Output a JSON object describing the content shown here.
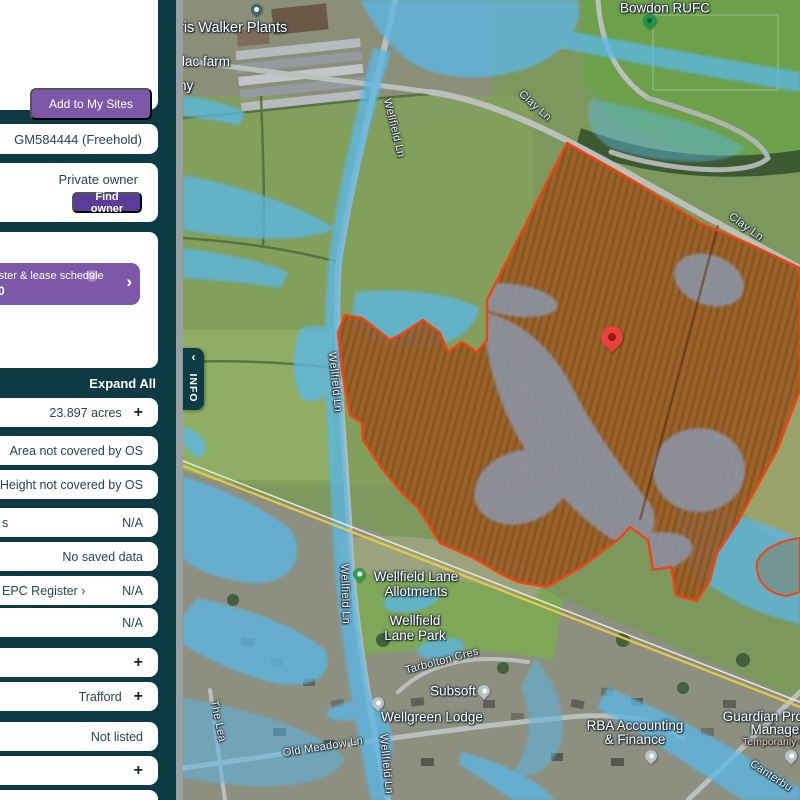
{
  "sidebar": {
    "add_button": "Add to My Sites",
    "title_ref": "GM584444 (Freehold)",
    "ownership": {
      "status": "Private owner",
      "find_owner": "Find owner"
    },
    "purchase_banner": {
      "line1": "gister & lease schedule",
      "help_badge": "?",
      "line2": ".00",
      "chevron": "›"
    },
    "expand_all": "Expand All",
    "rows": [
      {
        "label": "",
        "value": "23.897 acres",
        "expand": "+"
      },
      {
        "label": "",
        "value": "Area not covered by OS",
        "expand": ""
      },
      {
        "label": "",
        "value": "Height not covered by OS",
        "expand": ""
      },
      {
        "label": "s",
        "value": "N/A",
        "expand": ""
      },
      {
        "label": "",
        "value": "No saved data",
        "expand": ""
      },
      {
        "label": "EPC Register ›",
        "value": "N/A",
        "expand": ""
      },
      {
        "label": "",
        "value": "N/A",
        "expand": ""
      },
      {
        "label": "",
        "value": "",
        "expand": "+"
      },
      {
        "label": "",
        "value": "Trafford",
        "expand": "+"
      },
      {
        "label": "",
        "value": "Not listed",
        "expand": ""
      },
      {
        "label": "",
        "value": "",
        "expand": "+"
      }
    ]
  },
  "map": {
    "info_tab": {
      "label": "INFO",
      "collapse": "‹"
    },
    "labels": {
      "bowdon_rufc": "Bowdon RUFC",
      "walker_plants": "ris Walker Plants",
      "lilac_farm": "ilac farm",
      "farm_suffix": "ny",
      "clay_ln": "Clay Ln",
      "wellfield_ln": "Wellfield Ln",
      "allotments_line1": "Wellfield Lane",
      "allotments_line2": "Allotments",
      "park_line1": "Wellfield",
      "park_line2": "Lane Park",
      "tarbolton_cres": "Tarbolton Cres",
      "subsoft": "Subsoft",
      "wellgreen_lodge": "Wellgreen Lodge",
      "rba_line1": "RBA Accounting",
      "rba_line2": "& Finance",
      "guardian_line1": "Guardian Prope",
      "guardian_line2": "Manageme",
      "guardian_line3": "Temporarily clos",
      "canterbury": "Canterbu",
      "old_meadow_ln": "Old Meadow Ln",
      "the_lea": "The Lea"
    },
    "pins": {
      "selected_site": "red-location-pin",
      "bowdon_rufc": "green-poi-pin",
      "walker_plants": "poi-pin",
      "allotments": "green-park-pin",
      "subsoft": "grey-poi-pin",
      "wellgreen_lodge": "grey-poi-pin",
      "rba": "grey-poi-pin",
      "guardian": "grey-poi-pin"
    },
    "colors": {
      "flood_overlay_blue": "#5cb7e5",
      "flood_zone_slate": "#8c97ac",
      "parcel_outline": "#ee4511",
      "parcel_fill": "#9c5a22",
      "selected_pin": "#e6443a",
      "accent_purple": "#7d57a8",
      "deep_purple": "#5b3c98",
      "sidebar_bg": "#0d3a43"
    }
  }
}
